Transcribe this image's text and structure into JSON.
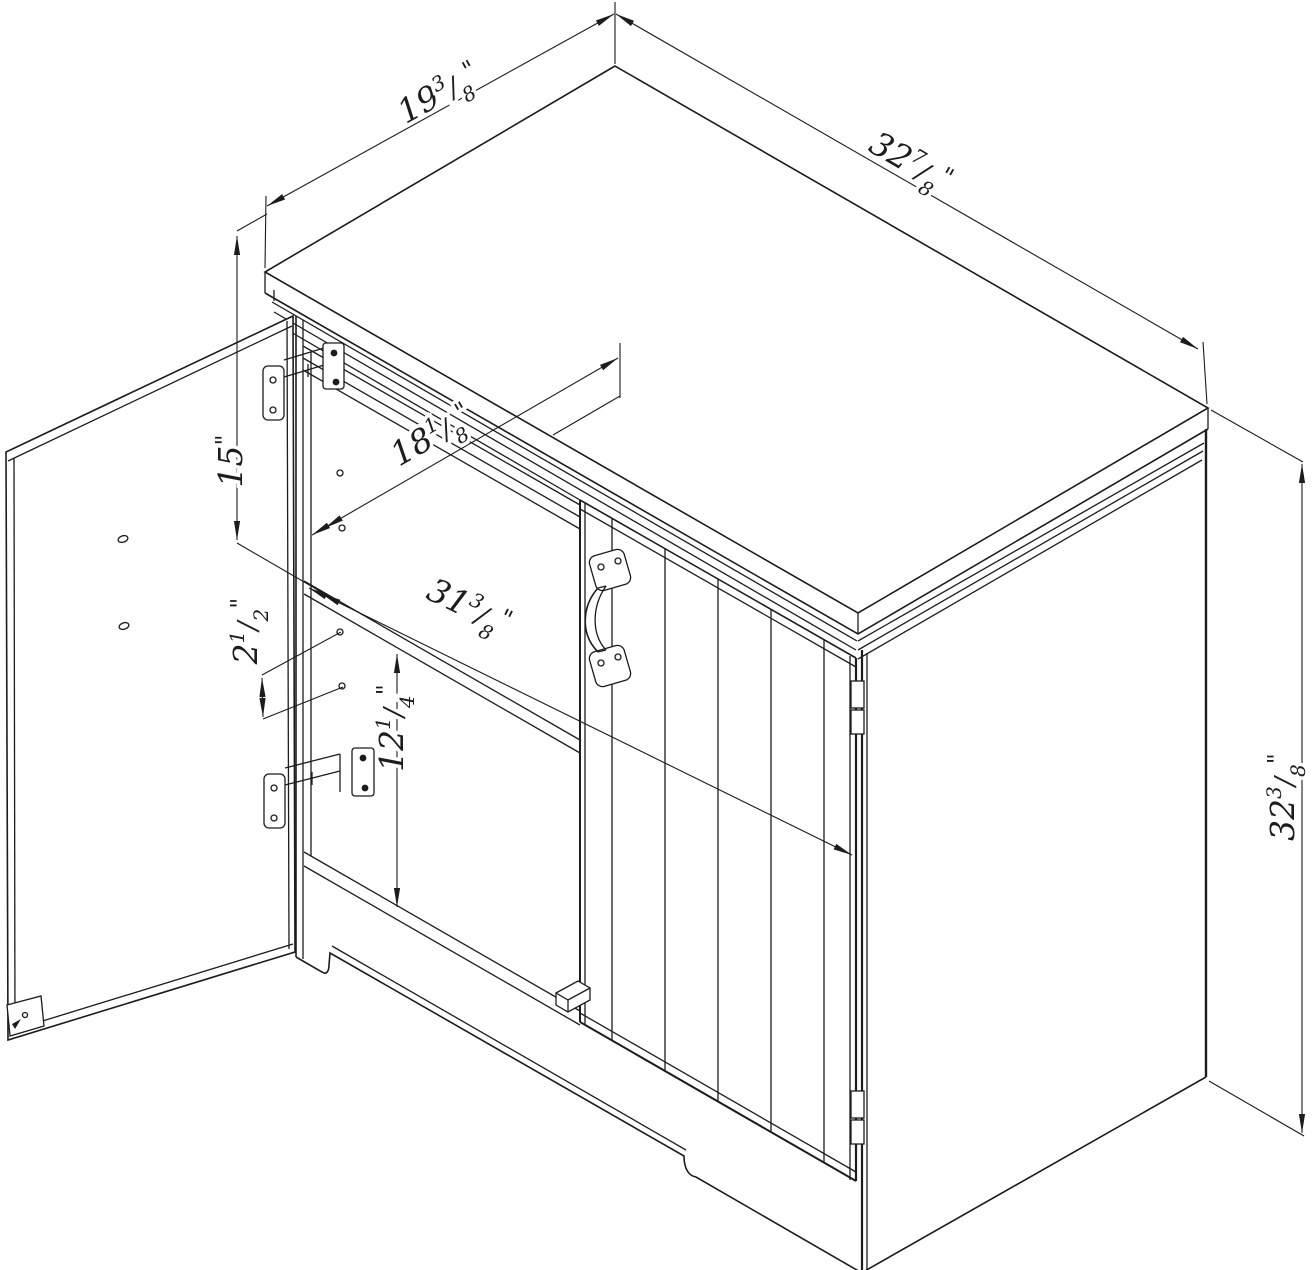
{
  "page": {
    "background": "#ffffff",
    "line_color": "#1c1c1c"
  },
  "dimensions": {
    "top_depth": {
      "whole": "19",
      "num": "3",
      "den": "8",
      "unit": "\""
    },
    "top_width": {
      "whole": "32",
      "num": "7",
      "den": "8",
      "unit": "\""
    },
    "opening_height": {
      "whole": "15",
      "num": "",
      "den": "",
      "unit": "\""
    },
    "interior_depth": {
      "whole": "18",
      "num": "1",
      "den": "8",
      "unit": "\""
    },
    "interior_width": {
      "whole": "31",
      "num": "3",
      "den": "8",
      "unit": "\""
    },
    "shelf_pin_spacing": {
      "whole": "2",
      "num": "1",
      "den": "2",
      "unit": "\""
    },
    "lower_section_height": {
      "whole": "12",
      "num": "1",
      "den": "4",
      "unit": "\""
    },
    "side_height": {
      "whole": "32",
      "num": "3",
      "den": "8",
      "unit": "\""
    }
  }
}
